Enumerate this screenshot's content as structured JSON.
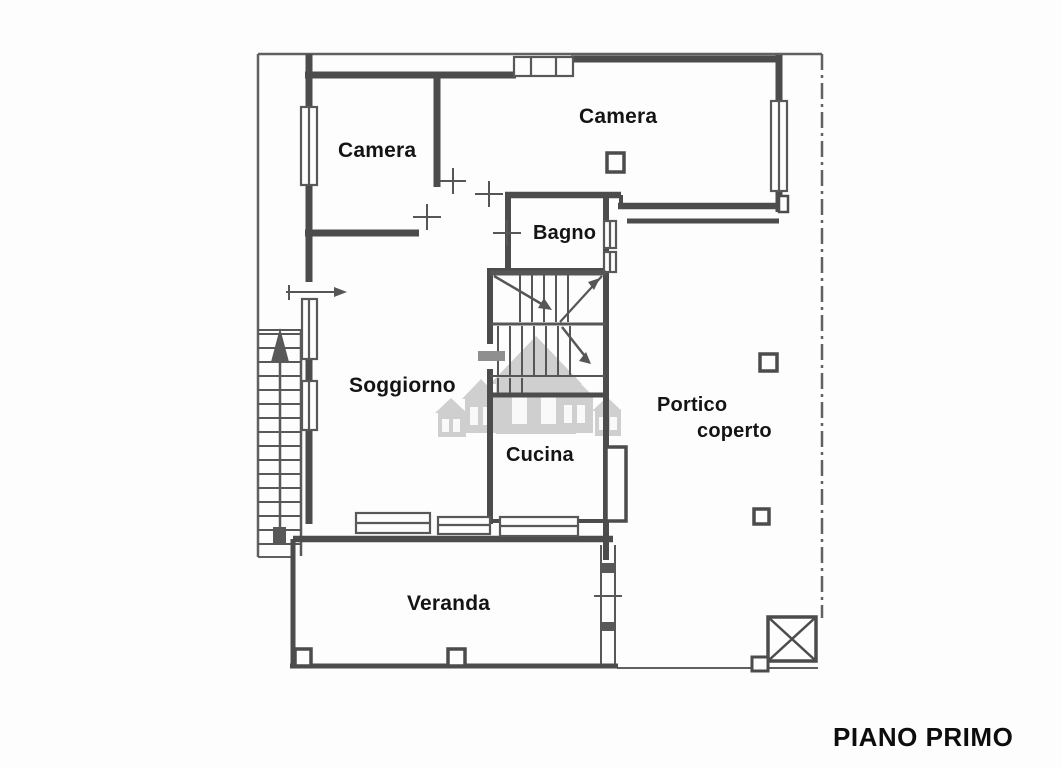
{
  "floor_label": "PIANO PRIMO",
  "rooms": {
    "camera_left": {
      "label": "Camera"
    },
    "camera_right": {
      "label": "Camera"
    },
    "bagno": {
      "label": "Bagno"
    },
    "soggiorno": {
      "label": "Soggiorno"
    },
    "cucina": {
      "label": "Cucina"
    },
    "portico": {
      "line1": "Portico",
      "line2": "coperto"
    },
    "veranda": {
      "label": "Veranda"
    }
  },
  "symbols": {
    "external_stair_arrow": "up",
    "entrance_arrow": "right",
    "shaft_box": "crossed-square"
  },
  "colors": {
    "wall": "#4c4c4c",
    "thin_line": "#606060",
    "label_text": "#141414",
    "watermark": "#ababab",
    "background": "#fdfdfd"
  }
}
